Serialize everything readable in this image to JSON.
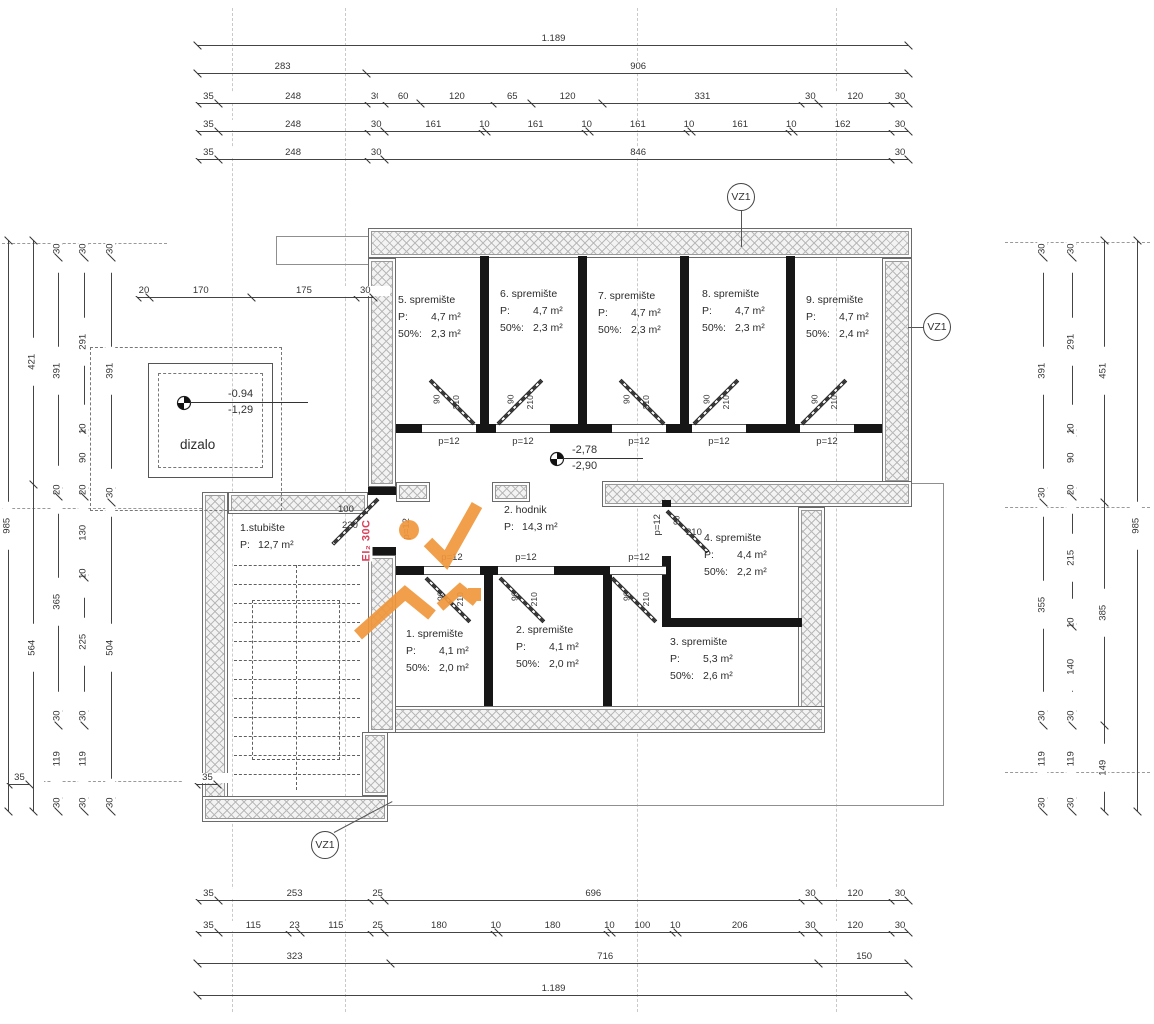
{
  "rooms": {
    "r1": {
      "name": "1. spremište",
      "p": "P:",
      "p_val": "4,1 m²",
      "h": "50%:",
      "h_val": "2,0 m²"
    },
    "r2": {
      "name": "2. spremište",
      "p": "P:",
      "p_val": "4,1 m²",
      "h": "50%:",
      "h_val": "2,0 m²"
    },
    "r3": {
      "name": "3. spremište",
      "p": "P:",
      "p_val": "5,3 m²",
      "h": "50%:",
      "h_val": "2,6 m²"
    },
    "r4": {
      "name": "4. spremište",
      "p": "P:",
      "p_val": "4,4 m²",
      "h": "50%:",
      "h_val": "2,2 m²"
    },
    "r5": {
      "name": "5. spremište",
      "p": "P:",
      "p_val": "4,7 m²",
      "h": "50%:",
      "h_val": "2,3 m²"
    },
    "r6": {
      "name": "6. spremište",
      "p": "P:",
      "p_val": "4,7 m²",
      "h": "50%:",
      "h_val": "2,3 m²"
    },
    "r7": {
      "name": "7. spremište",
      "p": "P:",
      "p_val": "4,7 m²",
      "h": "50%:",
      "h_val": "2,3 m²"
    },
    "r8": {
      "name": "8. spremište",
      "p": "P:",
      "p_val": "4,7 m²",
      "h": "50%:",
      "h_val": "2,3 m²"
    },
    "r9": {
      "name": "9. spremište",
      "p": "P:",
      "p_val": "4,7 m²",
      "h": "50%:",
      "h_val": "2,4 m²"
    },
    "hodnik": {
      "name": "2. hodnik",
      "p": "P:",
      "p_val": "14,3 m²"
    },
    "stubiste": {
      "name": "1.stubište",
      "p": "P:",
      "p_val": "12,7 m²"
    },
    "dizalo": {
      "name": "dizalo"
    }
  },
  "levels": {
    "lift_top": "-0.94",
    "lift_bottom": "-1,29",
    "floor_top": "-2,78",
    "floor_bottom": "-2,90"
  },
  "vent_label": "VZ1",
  "door_labels": {
    "w": "90",
    "h": "210",
    "sill": "p=12",
    "stair_w": "100",
    "stair_h": "220"
  },
  "fire_label": "EI₂ 30C",
  "colors": {
    "accent_orange": "#f0973b",
    "fire_red": "#d8435c",
    "wall_black": "#161616"
  },
  "dims": {
    "h": [
      {
        "y": 45,
        "x0": 197,
        "labels": [
          "1.189"
        ]
      },
      {
        "y": 73,
        "x0": 197,
        "labels": [
          "283",
          "906"
        ]
      },
      {
        "y": 103,
        "x0": 197,
        "labels": [
          "35",
          "248",
          "30",
          "60",
          "120",
          "65",
          "120",
          "331",
          "30",
          "120",
          "30"
        ]
      },
      {
        "y": 131,
        "x0": 197,
        "labels": [
          "35",
          "248",
          "30",
          "161",
          "10",
          "161",
          "10",
          "161",
          "10",
          "161",
          "10",
          "162",
          "30"
        ]
      },
      {
        "y": 159,
        "x0": 197,
        "labels": [
          "35",
          "248",
          "30",
          "846",
          "30"
        ]
      },
      {
        "y": 297,
        "x0": 137,
        "labels": [
          "20",
          "170",
          "175",
          "30"
        ]
      },
      {
        "y": 784,
        "x0": 8,
        "labels": [
          "35"
        ]
      },
      {
        "y": 784,
        "x0": 196,
        "labels": [
          "35"
        ]
      },
      {
        "y": 900,
        "x0": 197,
        "labels": [
          "35",
          "253",
          "25",
          "696",
          "30",
          "120",
          "30"
        ]
      },
      {
        "y": 932,
        "x0": 197,
        "labels": [
          "35",
          "115",
          "23",
          "115",
          "25",
          "180",
          "10",
          "180",
          "10",
          "100",
          "10",
          "206",
          "30",
          "120",
          "30"
        ]
      },
      {
        "y": 963,
        "x0": 197,
        "labels": [
          "323",
          "716",
          "150"
        ]
      },
      {
        "y": 995,
        "x0": 197,
        "labels": [
          "1.189"
        ]
      }
    ],
    "v": [
      {
        "x": 8,
        "y0": 240,
        "labels": [
          "985"
        ]
      },
      {
        "x": 33,
        "y0": 240,
        "labels": [
          "421",
          "564"
        ]
      },
      {
        "x": 58,
        "y0": 240,
        "labels": [
          "30",
          "391",
          "20",
          "365",
          "30",
          "119",
          "30"
        ]
      },
      {
        "x": 84,
        "y0": 240,
        "labels": [
          "30",
          "291",
          "10",
          "90",
          "20",
          "130",
          "10",
          "225",
          "30",
          "119",
          "30"
        ]
      },
      {
        "x": 111,
        "y0": 240,
        "labels": [
          "30",
          "391",
          "30",
          "504",
          "30"
        ]
      },
      {
        "x": 1043,
        "y0": 240,
        "labels": [
          "30",
          "391",
          "30",
          "355",
          "30",
          "119",
          "30"
        ]
      },
      {
        "x": 1072,
        "y0": 240,
        "labels": [
          "30",
          "291",
          "10",
          "90",
          "20",
          "215",
          "10",
          "140",
          "30",
          "119",
          "30"
        ]
      },
      {
        "x": 1104,
        "y0": 240,
        "labels": [
          "451",
          "385",
          "149"
        ]
      },
      {
        "x": 1137,
        "y0": 240,
        "labels": [
          "985"
        ]
      }
    ]
  }
}
